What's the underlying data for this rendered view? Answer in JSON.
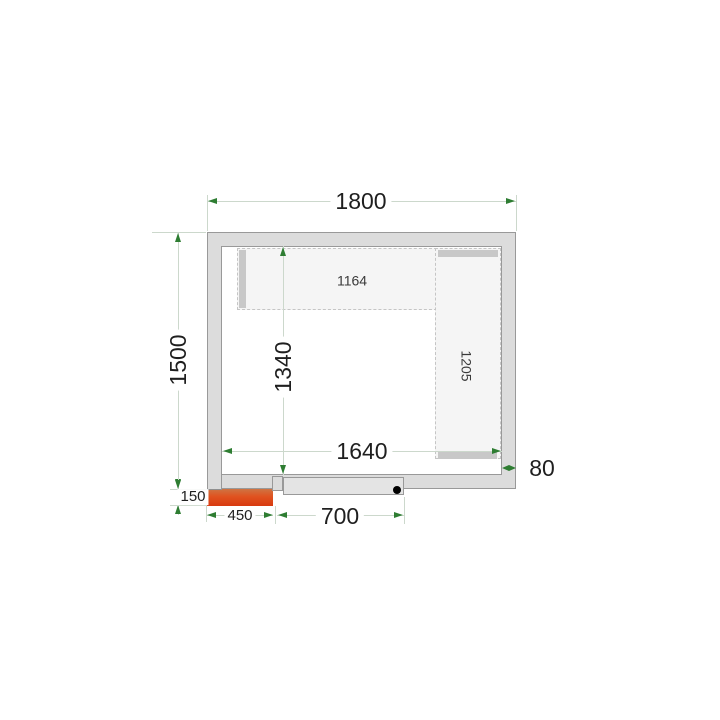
{
  "labels": {
    "outer_width": "1800",
    "outer_depth": "1500",
    "inner_width": "1640",
    "inner_depth": "1340",
    "wall_thickness": "80",
    "top_shelf_length": "1164",
    "right_shelf_length": "1205",
    "unit_width": "450",
    "unit_protrusion": "150",
    "door_width": "700"
  },
  "colors": {
    "wall_fill": "#dcdcdc",
    "wall_line": "#999999",
    "shelf_fill": "#f5f5f5",
    "shelf_bar": "#c8c8c8",
    "door_fill": "#e4e4e4",
    "dimension_line": "#ccd8cc",
    "arrow_green": "#2e7d32",
    "unit_gradient_top": "#8ac4be",
    "unit_gradient_bottom": "#d83a10"
  }
}
